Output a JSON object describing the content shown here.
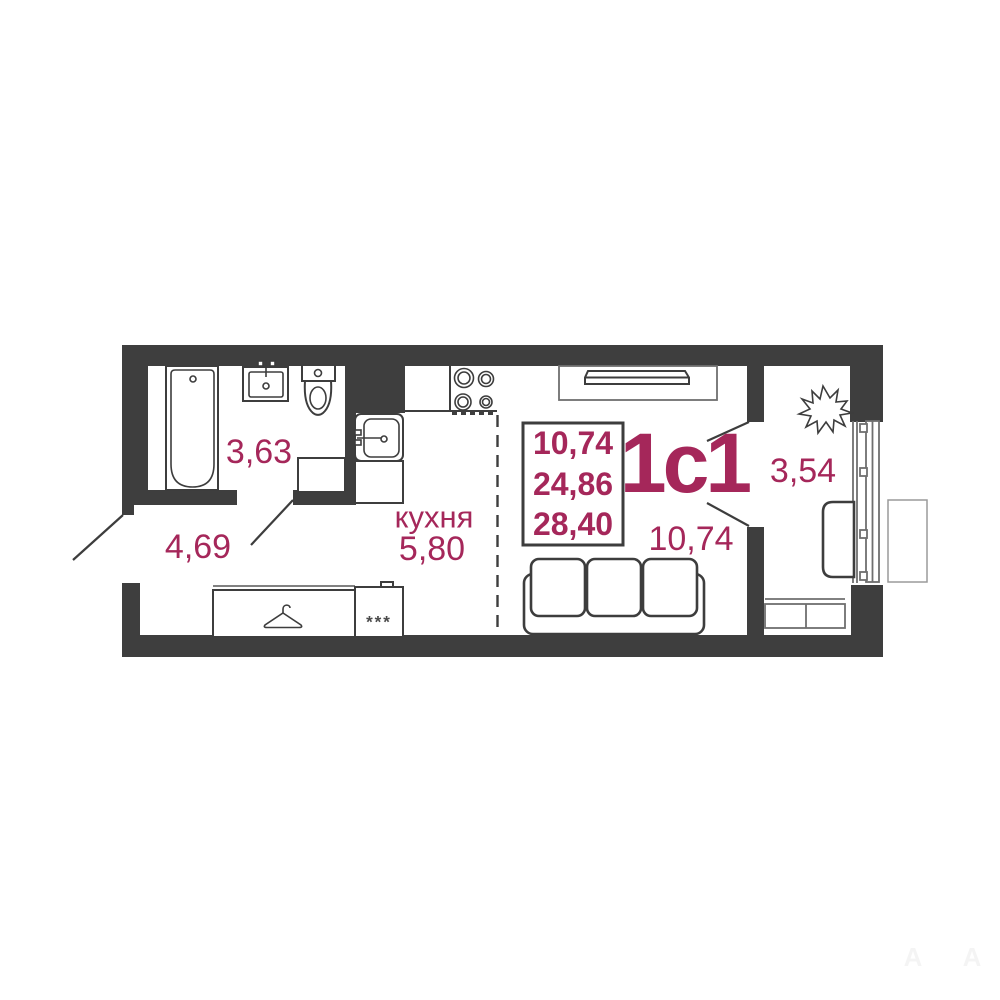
{
  "plan": {
    "unit_label": "1с1",
    "summary": {
      "values": [
        "10,74",
        "24,86",
        "28,40"
      ]
    },
    "rooms": {
      "bathroom_area": "3,63",
      "hallway_area": "4,69",
      "kitchen_label": "кухня",
      "kitchen_area": "5,80",
      "living_area": "10,74",
      "balcony_area": "3,54"
    },
    "markers": {
      "wardrobe_stars": "***",
      "watermark_left": "А",
      "watermark_right": "А"
    },
    "colors": {
      "accent": "#a5275a",
      "wall": "#3e3e3e",
      "line_dark": "#3d3d3d",
      "line_light": "#6f6f6f"
    },
    "icons": [
      "bathtub-icon",
      "bath-sink-icon",
      "toilet-icon",
      "washing-machine-icon",
      "stove-icon",
      "kitchen-sink-icon",
      "hanger-icon",
      "wardrobe-icon",
      "sofa-icon",
      "tv-icon",
      "tv-stand-icon",
      "plant-icon",
      "armchair-icon",
      "balcony-window-icon",
      "balcony-cabinet-icon",
      "outdoor-table-icon"
    ]
  }
}
